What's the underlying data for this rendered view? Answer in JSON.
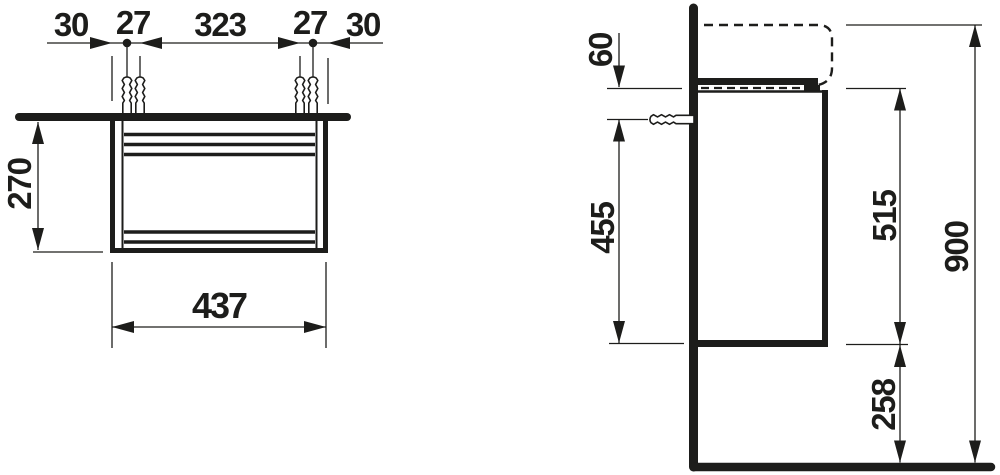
{
  "drawing": {
    "colors": {
      "line": "#1d1d1b",
      "background": "#ffffff"
    },
    "front_view": {
      "offset_left_mm": "30",
      "plug_gap_left_mm": "27",
      "plug_span_mm": "323",
      "plug_gap_right_mm": "27",
      "offset_right_mm": "30",
      "height_below_top_mm": "270",
      "cabinet_width_mm": "437"
    },
    "side_view": {
      "top_to_screw_mm": "60",
      "screw_to_bottom_mm": "455",
      "cabinet_height_mm": "515",
      "total_height_mm": "900",
      "floor_clearance_mm": "258"
    },
    "symbols": {
      "front_plug_count": 4,
      "side_screw_count": 1
    }
  }
}
